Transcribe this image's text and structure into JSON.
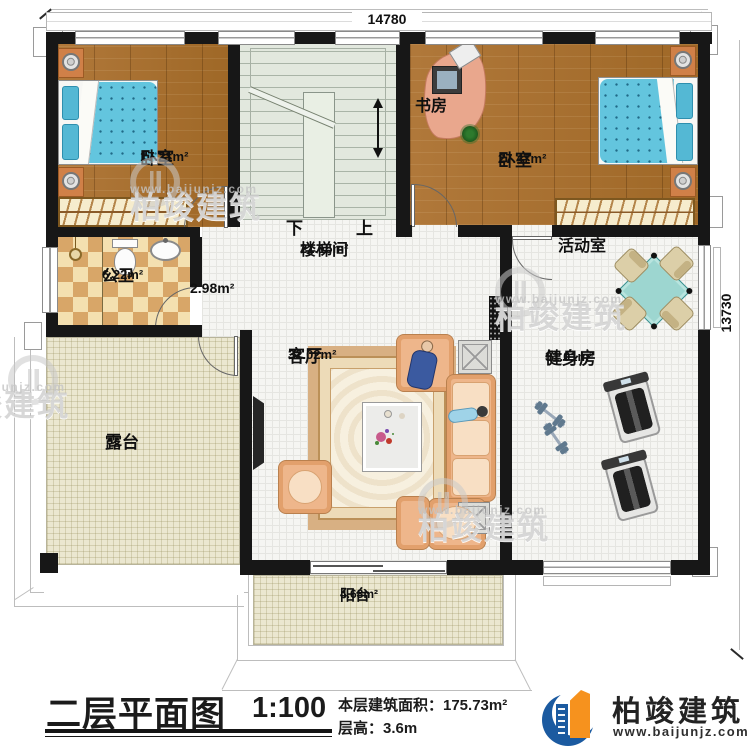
{
  "plan": {
    "dim_top": "14780",
    "dim_right": "13730",
    "stairs": {
      "down": "下",
      "up": "上"
    },
    "rooms": {
      "bedroom1": {
        "label": "卧室",
        "area": "17.21m²"
      },
      "study": {
        "label": "书房"
      },
      "bedroom2": {
        "label": "卧室",
        "area": "27.47m²"
      },
      "stairwell": {
        "label": "楼梯间",
        "area": "21.15m²"
      },
      "bathroom": {
        "label": "公卫",
        "area": "6.22m²"
      },
      "hallway": {
        "area": "2.98m²"
      },
      "activity": {
        "label": "活动室"
      },
      "living": {
        "label": "客厅",
        "area": "32.02m²"
      },
      "gym": {
        "label": "健身房",
        "area": "31.01m²"
      },
      "terrace": {
        "label": "露台"
      },
      "balcony": {
        "label": "阳台",
        "area": "4.68m²"
      }
    }
  },
  "titleblock": {
    "title": "二层平面图",
    "scale": "1:100",
    "area_label": "本层建筑面积：175.73m²",
    "floor_height_label": "层高：3.6m"
  },
  "brand": {
    "name": "柏竣建筑",
    "url": "www.baijunjz.com"
  },
  "watermark": {
    "name": "柏竣建筑",
    "url": "www.baijunjz.com"
  },
  "colors": {
    "wall": "#171717",
    "wood": "#a9722f",
    "stair_floor": "#e2e8de",
    "tile_light": "#f4e0b0",
    "tile_dark": "#d8a668",
    "terrace_floor": "#ebe7d0",
    "bed_blue": "#63c5de",
    "sofa_peach": "#eeb68b",
    "table_teal": "#9dd6d0",
    "brand_blue": "#1b5aa0",
    "brand_orange": "#f6921e"
  }
}
